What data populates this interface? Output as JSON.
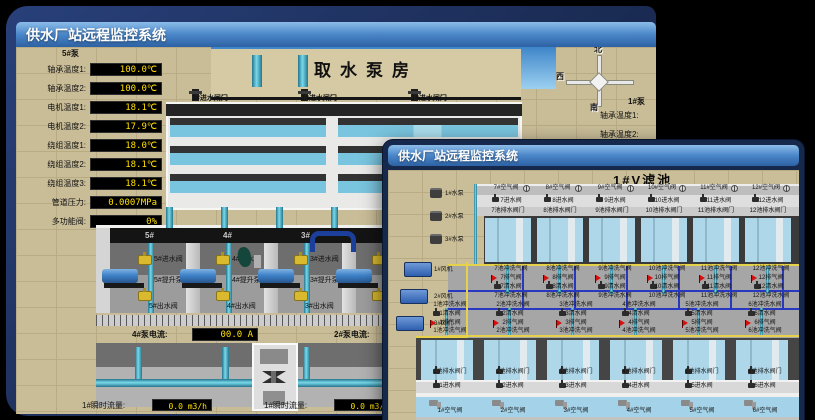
{
  "app": {
    "back_window": {
      "title": "供水厂站远程监控系统",
      "room_title": "取水泵房",
      "pump_panel": {
        "header": "5#泵",
        "readings": [
          {
            "label": "轴承温度1",
            "value": "100.0℃"
          },
          {
            "label": "轴承温度2",
            "value": "100.0℃"
          },
          {
            "label": "电机温度1",
            "value": "18.1℃"
          },
          {
            "label": "电机温度2",
            "value": "17.9℃"
          },
          {
            "label": "绕组温度1",
            "value": "18.0℃"
          },
          {
            "label": "绕组温度2",
            "value": "18.1℃"
          },
          {
            "label": "绕组温度3",
            "value": "18.1℃"
          },
          {
            "label": "管道压力",
            "value": "0.0007MPa"
          },
          {
            "label": "多功能阀",
            "value": "0%"
          }
        ]
      },
      "gates": [
        {
          "label": "3#进水闸门"
        },
        {
          "label": "2#进水闸门"
        },
        {
          "label": "1#进水闸门"
        }
      ],
      "compass": {
        "north": "北",
        "west": "西",
        "south": "南"
      },
      "right_panel": {
        "header": "1#泵",
        "labels": [
          "轴承温度1",
          "轴承温度2"
        ]
      },
      "bays": [
        {
          "id": "5#",
          "inlet": "5#进水阀",
          "pump": "5#提升泵",
          "outlet": "5#出水阀"
        },
        {
          "id": "4#",
          "inlet": "4#进水阀",
          "pump": "4#提升泵",
          "outlet": "4#出水阀"
        },
        {
          "id": "3#",
          "inlet": "3#进水阀",
          "pump": "3#提升泵",
          "outlet": "3#出水阀"
        },
        {
          "id": "",
          "inlet": "",
          "pump": "",
          "outlet": ""
        }
      ],
      "current_readouts": [
        {
          "label": "4#泵电流",
          "value": "00.0 A"
        },
        {
          "label": "2#泵电流",
          "value": ""
        }
      ],
      "flow_readouts": [
        {
          "label": "1#瞬时流量",
          "value": "0.0 m3/h"
        },
        {
          "label": "1#瞬时流量",
          "value": "0.0 m3/h"
        }
      ]
    },
    "front_window": {
      "title": "供水厂站远程监控系统",
      "pool_title": "1#V滤池",
      "equipment": {
        "pumps": [
          {
            "label": "1#水泵"
          },
          {
            "label": "2#水泵"
          },
          {
            "label": "3#水泵"
          }
        ],
        "blowers": [
          {
            "label": "1#风机"
          },
          {
            "label": "2#风机"
          },
          {
            "label": "3#风机"
          }
        ]
      },
      "top_pools": [
        {
          "air": "7#空气阀",
          "inlet": "7进水阀",
          "drain": "7池排水阀门",
          "wash_air": "7池冲洗气阀",
          "vent": "7排气阀",
          "clean": "7清水阀",
          "wash_water": "7池冲洗水阀"
        },
        {
          "air": "8#空气阀",
          "inlet": "8进水阀",
          "drain": "8池排水阀门",
          "wash_air": "8池冲洗气阀",
          "vent": "8排气阀",
          "clean": "8清水阀",
          "wash_water": "8池冲洗水阀"
        },
        {
          "air": "9#空气阀",
          "inlet": "9进水阀",
          "drain": "9池排水阀门",
          "wash_air": "9池冲洗气阀",
          "vent": "9排气阀",
          "clean": "9清水阀",
          "wash_water": "9池冲洗水阀"
        },
        {
          "air": "10#空气阀",
          "inlet": "10进水阀",
          "drain": "10池排水阀门",
          "wash_air": "10池冲洗气阀",
          "vent": "10排气阀",
          "clean": "10清水阀",
          "wash_water": "10池冲洗水阀"
        },
        {
          "air": "11#空气阀",
          "inlet": "11进水阀",
          "drain": "11池排水阀门",
          "wash_air": "11池冲洗气阀",
          "vent": "11排气阀",
          "clean": "11清水阀",
          "wash_water": "11池冲洗水阀"
        },
        {
          "air": "12#空气阀",
          "inlet": "12进水阀",
          "drain": "12池排水阀门",
          "wash_air": "12池冲洗气阀",
          "vent": "12排气阀",
          "clean": "12清水阀",
          "wash_water": "12池冲洗水阀"
        }
      ],
      "bottom_pools": [
        {
          "air": "1#空气阀",
          "inlet": "1进水阀",
          "drain": "1池排水阀门",
          "wash_air": "1池冲洗气阀",
          "vent": "1排气阀",
          "clean": "1清水阀",
          "wash_water": "1池冲洗水阀"
        },
        {
          "air": "2#空气阀",
          "inlet": "2进水阀",
          "drain": "2池排水阀门",
          "wash_air": "2池冲洗气阀",
          "vent": "2排气阀",
          "clean": "2清水阀",
          "wash_water": "2池冲洗水阀"
        },
        {
          "air": "3#空气阀",
          "inlet": "3进水阀",
          "drain": "3池排水阀门",
          "wash_air": "3池冲洗气阀",
          "vent": "3排气阀",
          "clean": "3清水阀",
          "wash_water": "3池冲洗水阀"
        },
        {
          "air": "4#空气阀",
          "inlet": "4进水阀",
          "drain": "4池排水阀门",
          "wash_air": "4池冲洗气阀",
          "vent": "4排气阀",
          "clean": "4清水阀",
          "wash_water": "4池冲洗水阀"
        },
        {
          "air": "5#空气阀",
          "inlet": "5进水阀",
          "drain": "5池排水阀门",
          "wash_air": "5池冲洗气阀",
          "vent": "5排气阀",
          "clean": "5清水阀",
          "wash_water": "5池冲洗水阀"
        },
        {
          "air": "6#空气阀",
          "inlet": "6进水阀",
          "drain": "6池排水阀门",
          "wash_air": "6池冲洗气阀",
          "vent": "6排气阀",
          "clean": "6清水阀",
          "wash_water": "6池冲洗水阀"
        }
      ]
    }
  }
}
